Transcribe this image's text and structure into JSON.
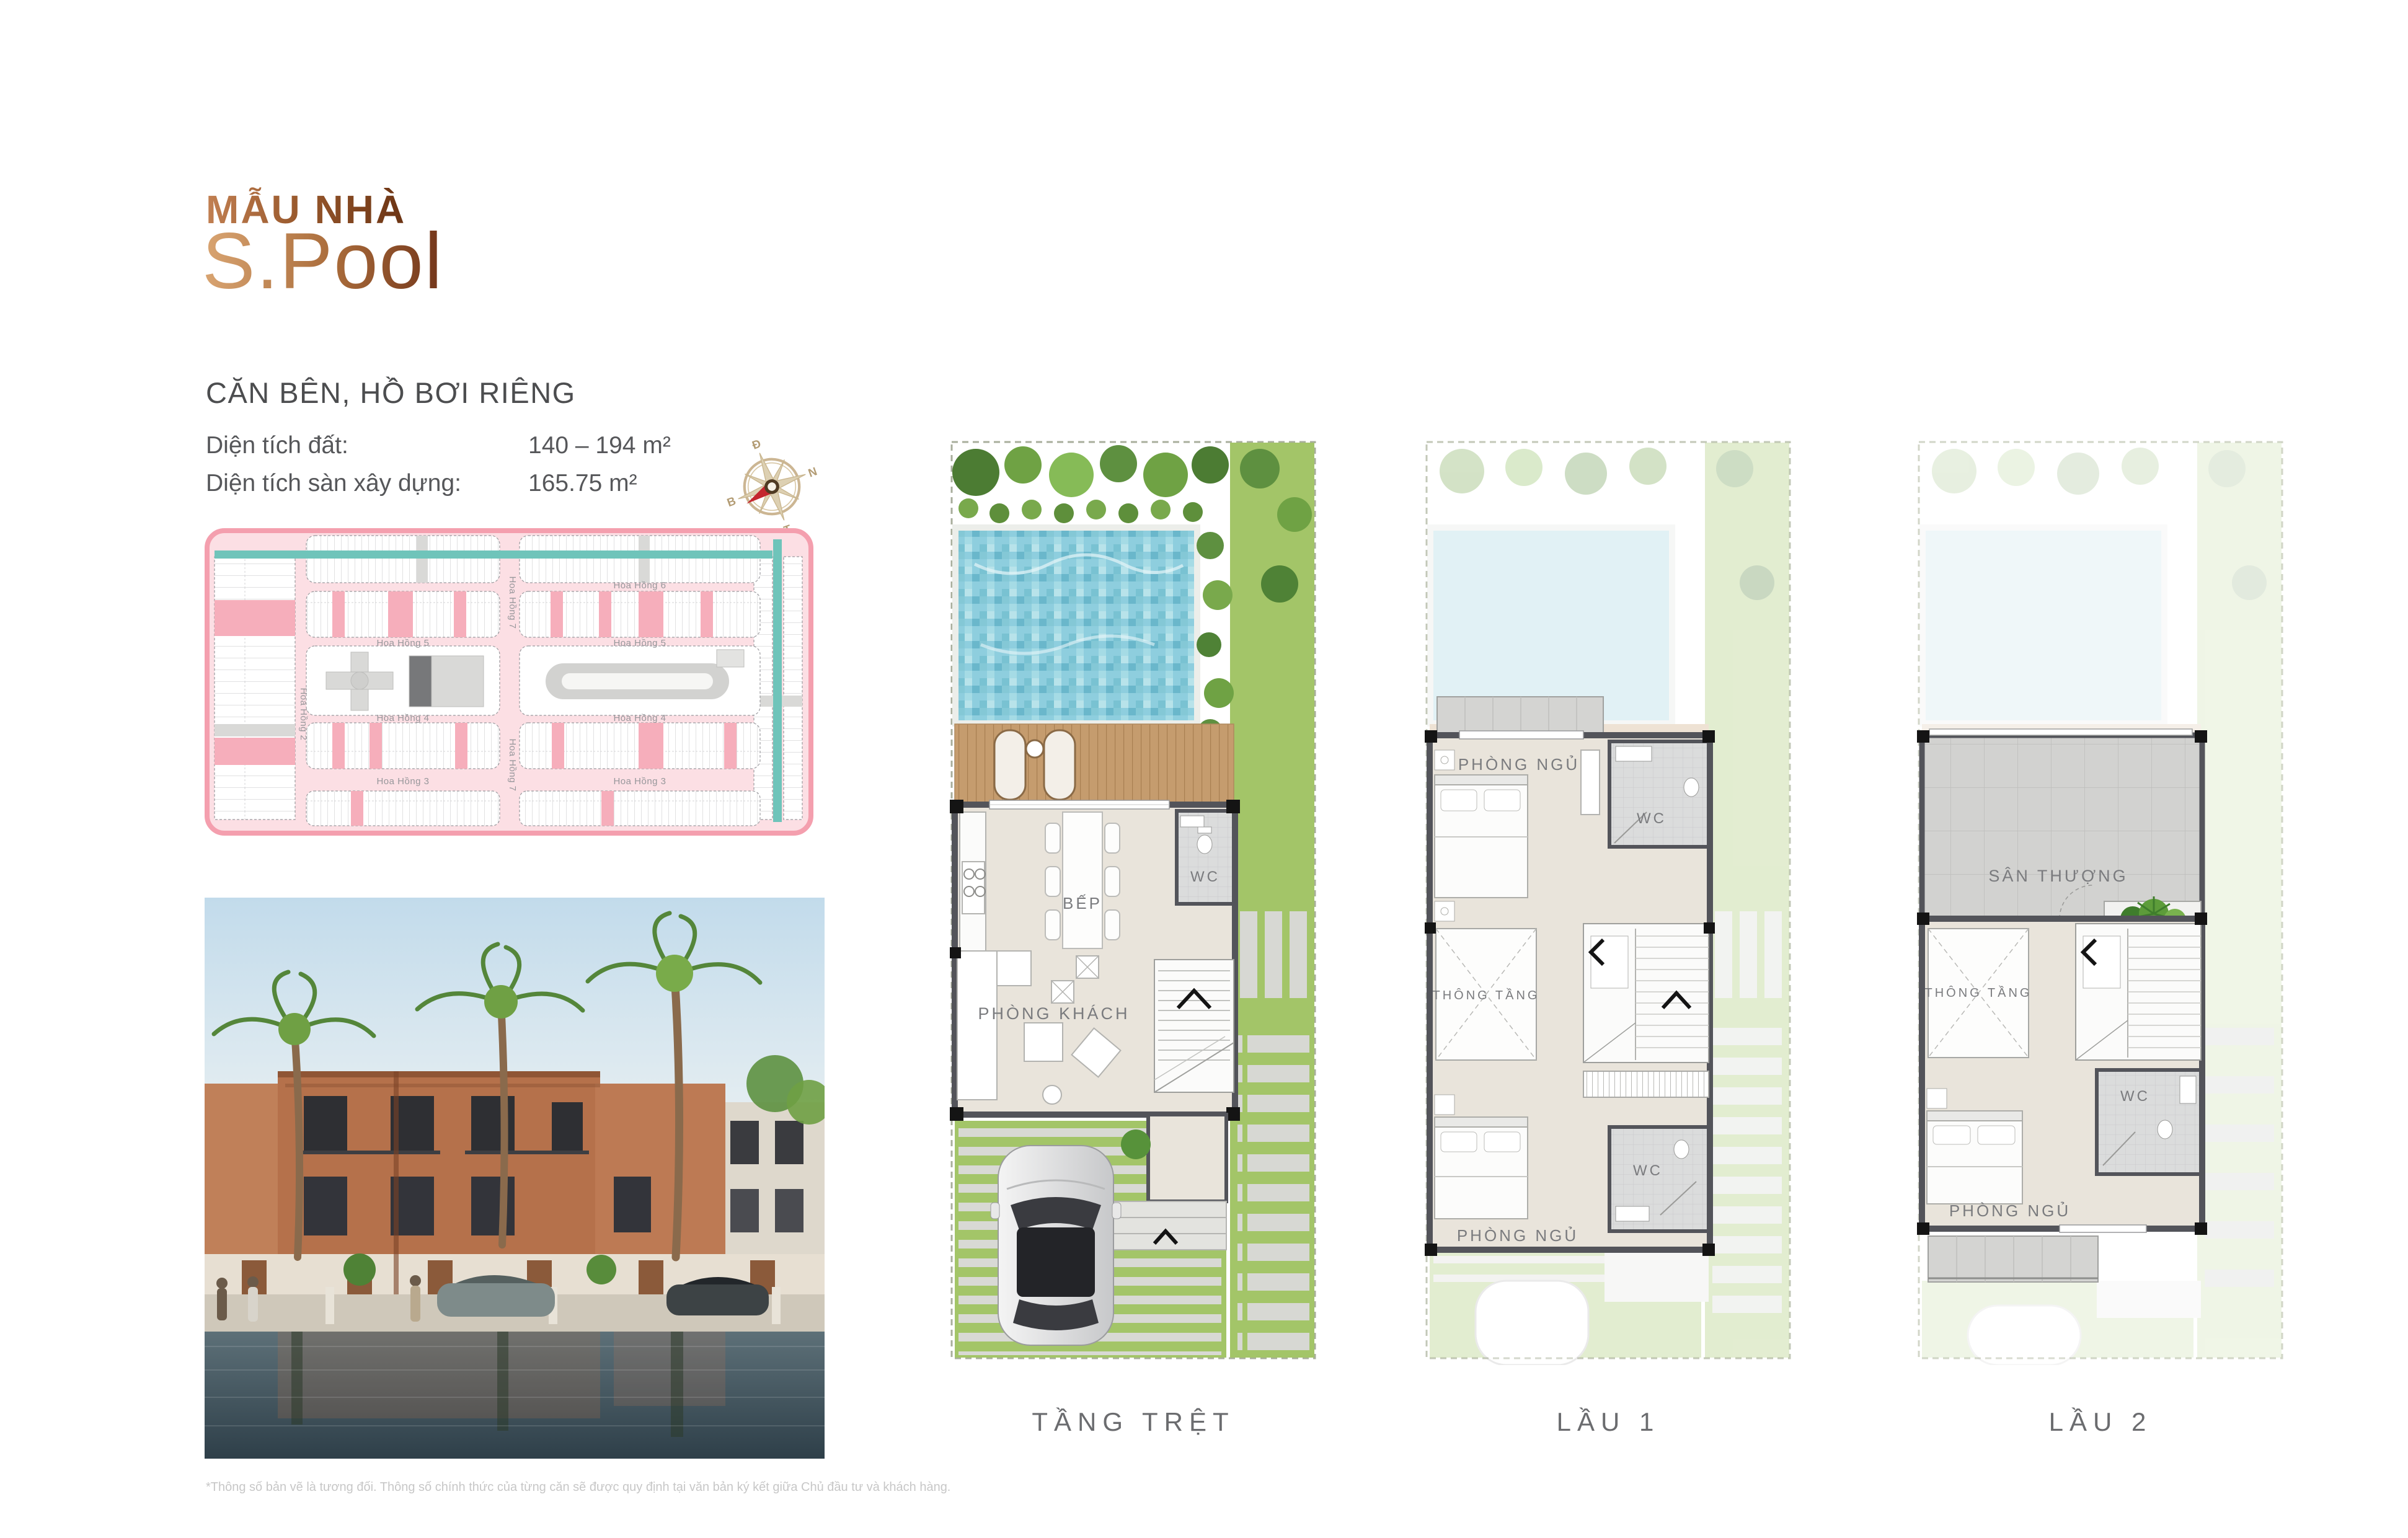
{
  "header": {
    "eyebrow": "MẪU NHÀ",
    "model_name": "S.Pool",
    "subtitle": "CĂN BÊN, HỒ BƠI RIÊNG",
    "specs": [
      {
        "label": "Diện tích đất:",
        "value": "140 – 194 m²"
      },
      {
        "label": "Diện tích sàn xây dựng:",
        "value": "165.75 m²"
      }
    ]
  },
  "compass": {
    "east": "Đ",
    "south": "N",
    "west": "T",
    "north": "B"
  },
  "site_plan": {
    "streets": {
      "hh6": "Hoa Hồng 6",
      "hh5_left": "Hoa Hồng 5",
      "hh5_right": "Hoa Hồng 5",
      "hh4_left": "Hoa Hồng 4",
      "hh4_right": "Hoa Hồng 4",
      "hh3_left": "Hoa Hồng 3",
      "hh3_right": "Hoa Hồng 3",
      "hh7_top": "Hoa Hồng 7",
      "hh7_bottom": "Hoa Hồng 7",
      "hh2": "Hoa Hồng 2"
    }
  },
  "floor_plans": [
    {
      "label": "TẦNG TRỆT",
      "rooms": {
        "kitchen": "BẾP",
        "wc": "WC",
        "living": "PHÒNG KHÁCH"
      }
    },
    {
      "label": "LẦU 1",
      "rooms": {
        "bedroom_top": "PHÒNG NGỦ",
        "wc_top": "WC",
        "void": "THÔNG TẦNG",
        "bedroom_bottom": "PHÒNG NGỦ",
        "wc_bottom": "WC"
      }
    },
    {
      "label": "LẦU 2",
      "rooms": {
        "terrace": "SÂN THƯỢNG",
        "void": "THÔNG TẦNG",
        "wc": "WC",
        "bedroom": "PHÒNG NGỦ"
      }
    }
  ],
  "footnote": "*Thông số bản vẽ là tương đối. Thông số chính thức của từng căn sẽ được quy định tại văn bản ký kết giữa Chủ đầu tư và khách hàng.",
  "colors": {
    "accent_brown": "#8a4722",
    "accent_copper": "#c98a58",
    "map_pink": "#f49fae",
    "map_teal": "#6fc4ba",
    "lawn_green": "#a3c568",
    "pool_blue": "#8ccbd9"
  }
}
